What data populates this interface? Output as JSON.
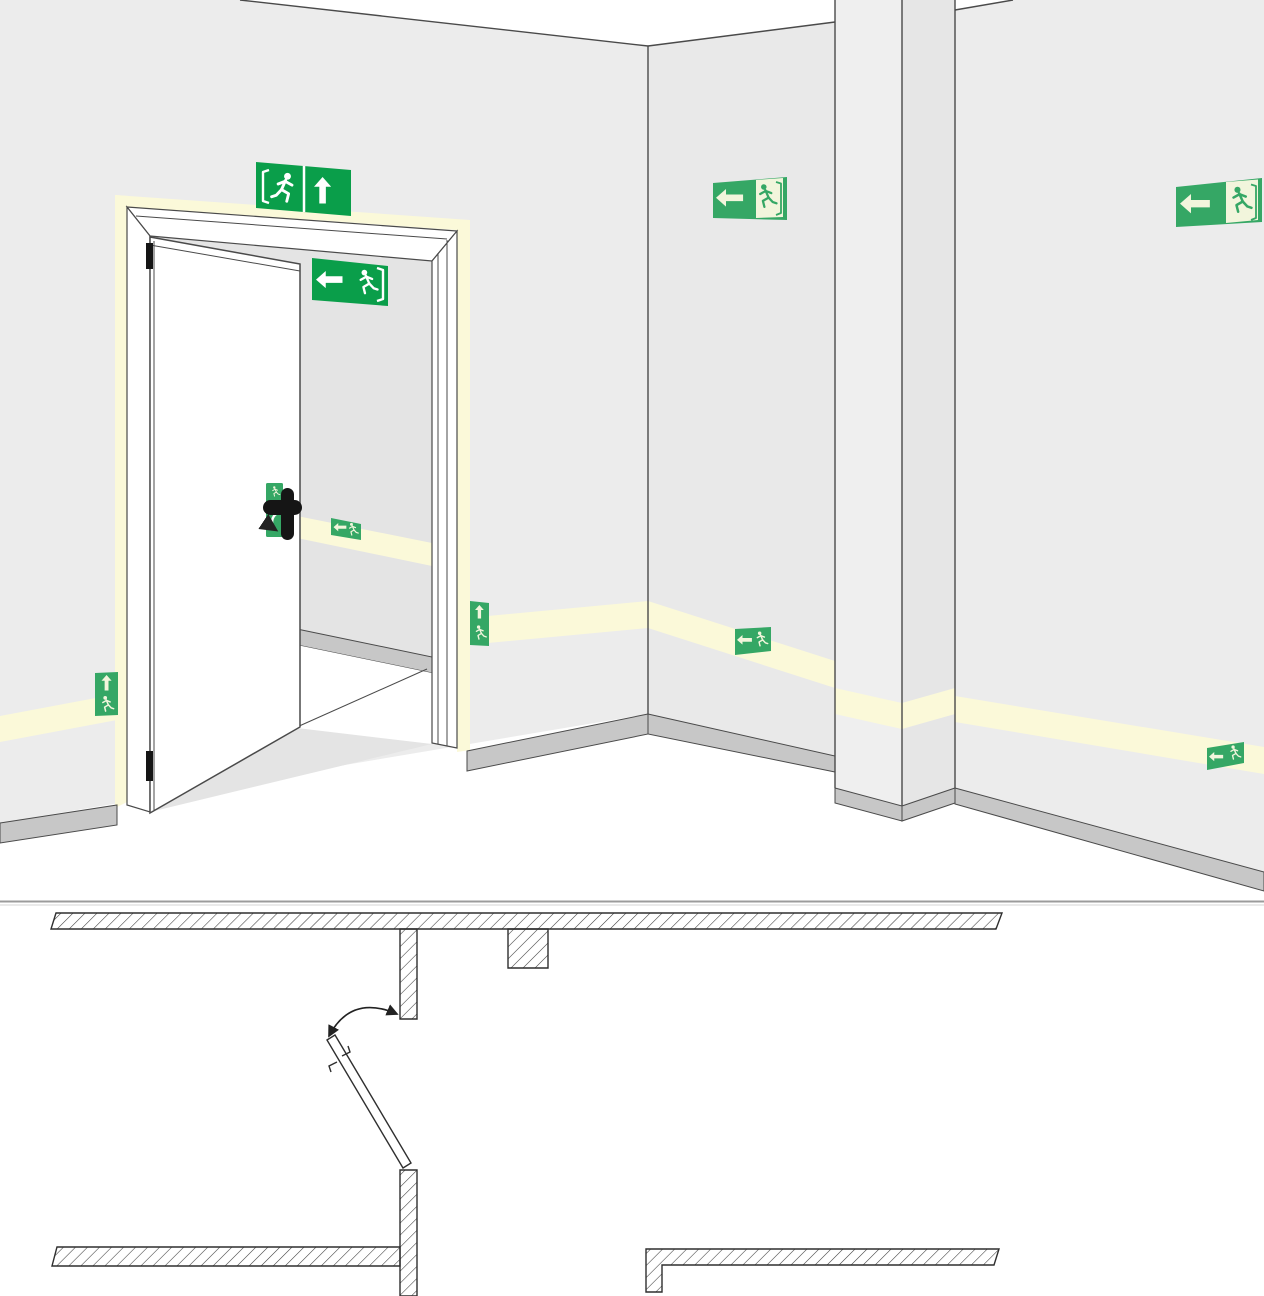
{
  "illustration": {
    "kind": "escape-route-signage-illustration",
    "colors": {
      "green": "#0a9e4a",
      "lumi": "#35a765",
      "cream": "#f2f5dc",
      "strip": "#fbf9d9",
      "wall": "#ececec",
      "wall_mid": "#e9e9e9",
      "pillar_l": "#efefef",
      "pillar_r": "#e6e6e6",
      "interior": "#e4e4e4",
      "skirt": "#c7c7c7",
      "line": "#4a4a4a",
      "plan_line": "#2f2f2f"
    },
    "perspective_view": {
      "signs": [
        {
          "id": "exit-sign-above-door",
          "pictograms": [
            "running-man-right-in-door",
            "arrow-up"
          ]
        },
        {
          "id": "exit-sign-inside-doorway",
          "pictograms": [
            "arrow-left",
            "running-man-left-in-door"
          ]
        },
        {
          "id": "exit-sign-corridor-wall",
          "pictograms": [
            "arrow-left",
            "running-man-left-in-door"
          ]
        },
        {
          "id": "exit-sign-right-wall",
          "pictograms": [
            "arrow-left",
            "running-man-left-in-door"
          ]
        },
        {
          "id": "low-sign-left-of-door",
          "pictograms": [
            "arrow-up",
            "running-man-left"
          ]
        },
        {
          "id": "low-sign-right-of-door",
          "pictograms": [
            "arrow-up",
            "running-man-left"
          ]
        },
        {
          "id": "strip-sign-corridor",
          "pictograms": [
            "arrow-left",
            "running-man-left"
          ]
        },
        {
          "id": "strip-sign-right-wall",
          "pictograms": [
            "arrow-left",
            "running-man-left"
          ]
        },
        {
          "id": "strip-sign-behind-door",
          "pictograms": [
            "arrow-left",
            "running-man-left"
          ]
        },
        {
          "id": "door-handle-sign",
          "pictograms": [
            "running-man",
            "curved-arrow-down"
          ]
        }
      ],
      "features": [
        "open-door-with-frame",
        "photoluminescent-door-surround",
        "low-level-guidance-strip",
        "wall-corner",
        "pillar",
        "skirting-boards",
        "door-handle",
        "door-hinges"
      ]
    },
    "floor_plan": {
      "features": [
        "top-wall-hatched",
        "door-jamb-upper",
        "wall-stub",
        "door-leaf-open",
        "door-swing-arc",
        "door-jamb-lower",
        "bottom-left-wall-hatched",
        "bottom-right-wall-hatched"
      ]
    }
  }
}
